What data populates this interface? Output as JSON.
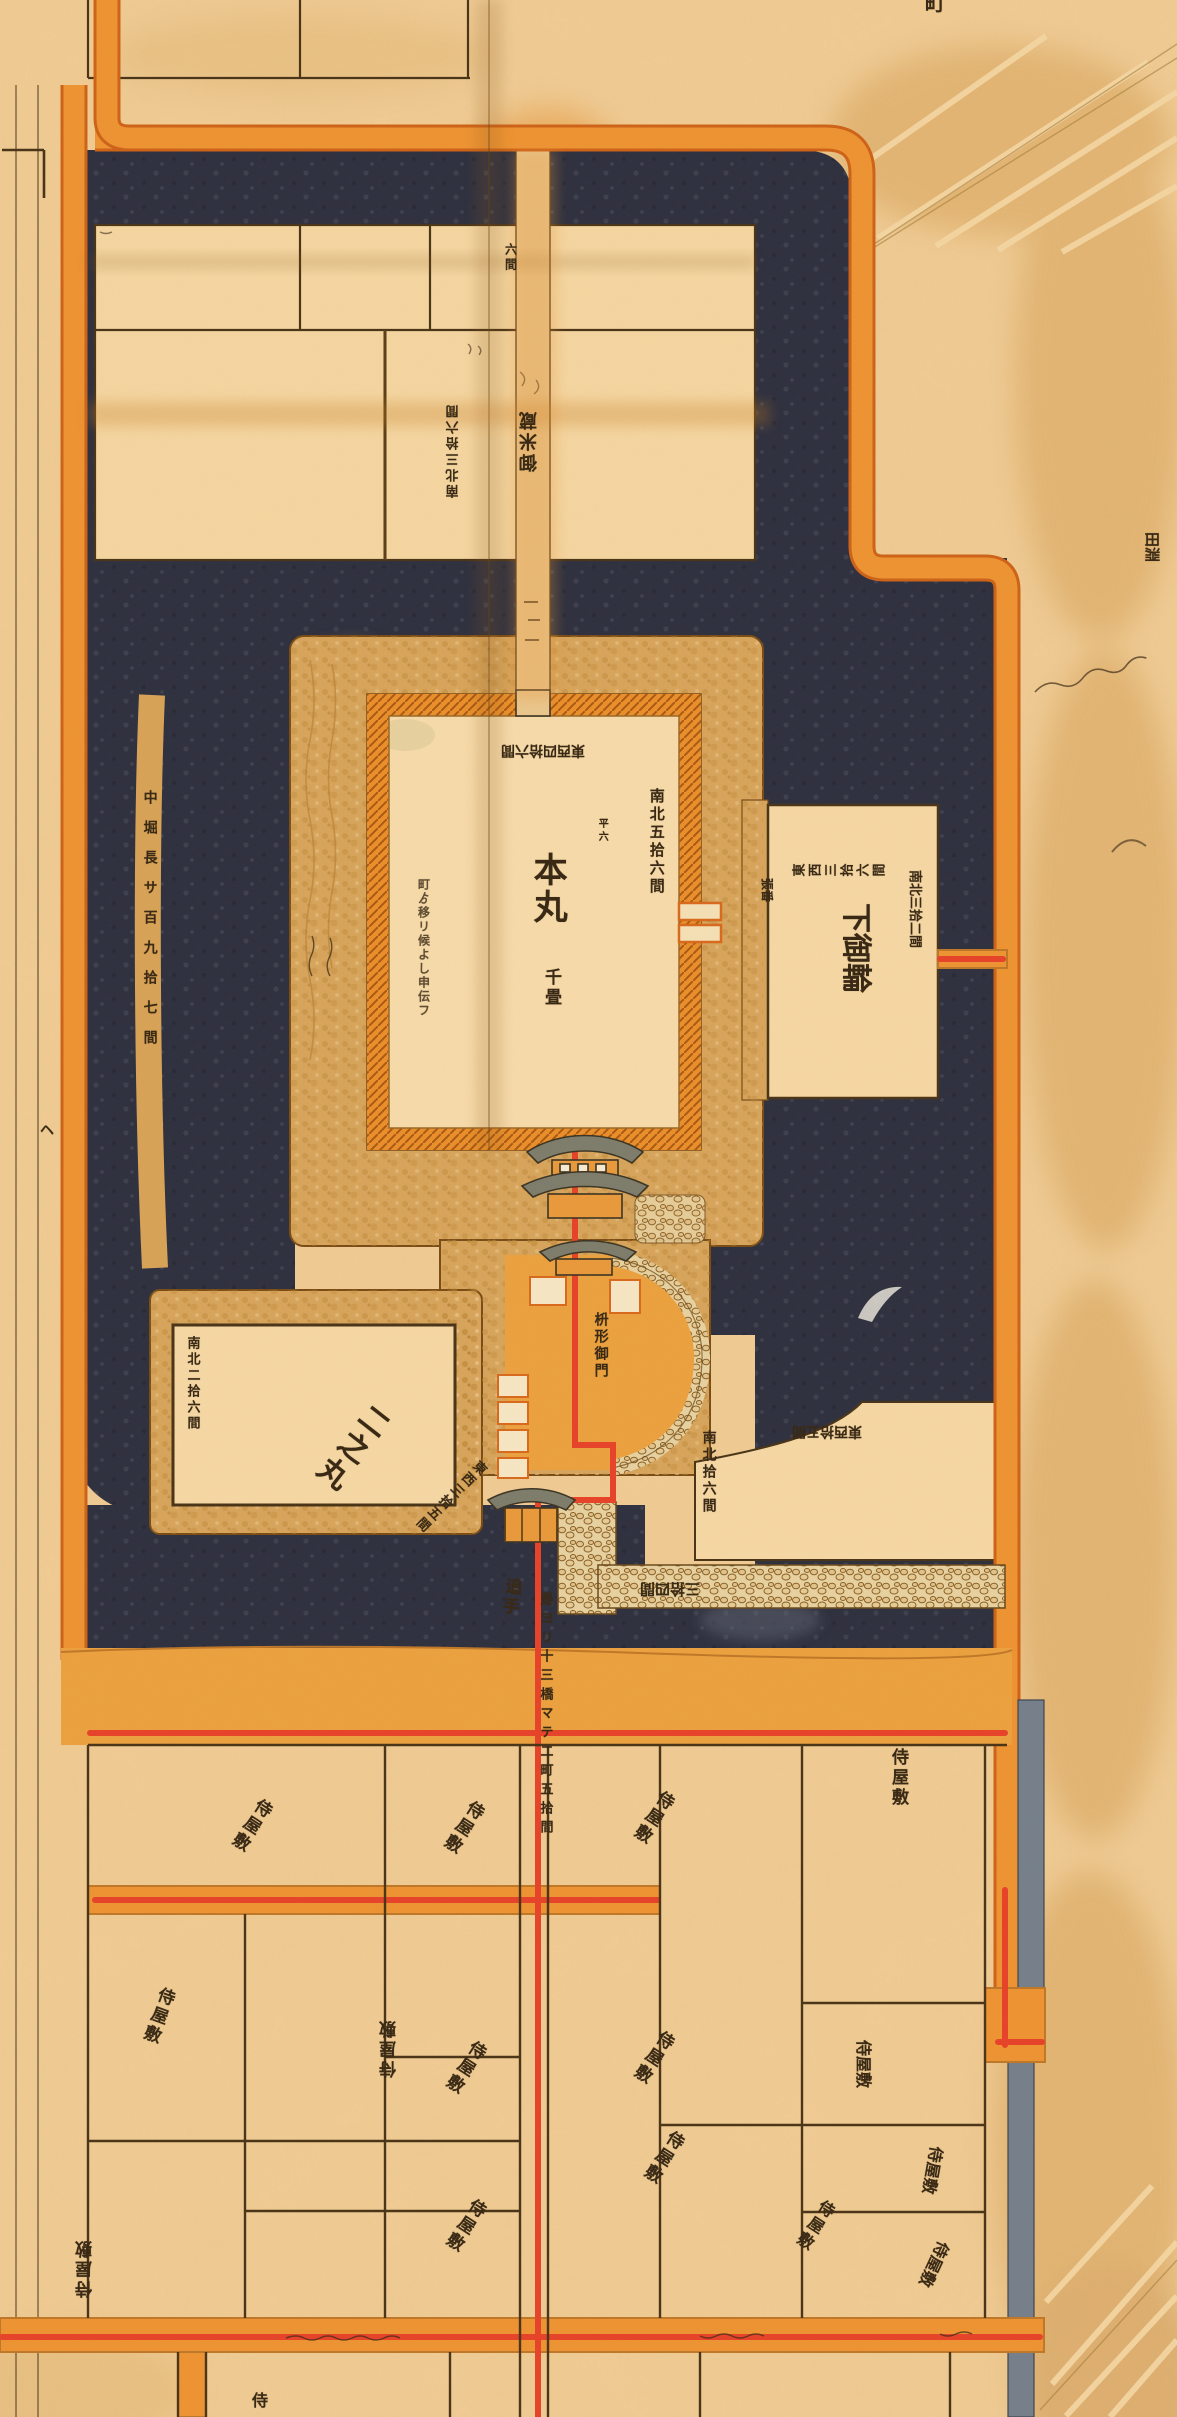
{
  "map_title": "castle-plan-map",
  "colors": {
    "paper": "#f2cd96",
    "paper_light": "#f8dcab",
    "moat_dark": "#2e3040",
    "stone_tan": "#d8a55c",
    "road_orange": "#ef9433",
    "road_edge": "#d96a1d",
    "road_red": "#e8432a",
    "wall_orange": "#ec8f2b",
    "ink": "#3a2a15",
    "drain_gray": "#76808c",
    "roof_gray": "#7e7d6c"
  },
  "labels": [
    {
      "name": "honmaru-label",
      "text": "本丸",
      "dir": "v",
      "x": 528,
      "y": 852,
      "size": 34
    },
    {
      "name": "honmaru-sub-label",
      "text": "千畳",
      "dir": "v",
      "x": 541,
      "y": 968,
      "size": 17
    },
    {
      "name": "honmaru-dim-ns",
      "text": "南北五拾六間",
      "dir": "v",
      "x": 648,
      "y": 788,
      "size": 15
    },
    {
      "name": "honmaru-dim-ew",
      "text": "東西四拾六間",
      "dir": "h",
      "x": 585,
      "y": 757,
      "size": 14,
      "rot": 180
    },
    {
      "name": "honmaru-note",
      "text": "町ゟ移リ候よし申伝フ",
      "dir": "v",
      "x": 416,
      "y": 878,
      "size": 12,
      "op": 0.8,
      "ls": 2
    },
    {
      "name": "honmaru-tiny-note",
      "text": "平六",
      "dir": "v",
      "x": 596,
      "y": 818,
      "size": 10
    },
    {
      "name": "bailey-plot-label",
      "text": "御米蔵",
      "dir": "v",
      "x": 540,
      "y": 472,
      "size": 18,
      "rot": 180
    },
    {
      "name": "bailey-dim-ns",
      "text": "南北三拾六間",
      "dir": "v",
      "x": 462,
      "y": 498,
      "size": 13,
      "rot": 180
    },
    {
      "name": "axis-road-note",
      "text": "六間",
      "dir": "v",
      "x": 503,
      "y": 243,
      "size": 12
    },
    {
      "name": "shimokuruwa-label",
      "text": "下御輪",
      "dir": "h",
      "x": 872,
      "y": 903,
      "size": 30,
      "rot": 90
    },
    {
      "name": "shimokuruwa-dim-ew",
      "text": "東西三拾六間",
      "dir": "v",
      "x": 792,
      "y": 880,
      "size": 13,
      "rot": -90
    },
    {
      "name": "shimokuruwa-dim-ns",
      "text": "南北三拾二間",
      "dir": "h",
      "x": 921,
      "y": 870,
      "size": 13,
      "rot": 90
    },
    {
      "name": "shimokuruwa-tiny",
      "text": "張番",
      "dir": "h",
      "x": 773,
      "y": 878,
      "size": 12,
      "rot": 90
    },
    {
      "name": "ninomaru-label",
      "text": "二之丸",
      "dir": "v",
      "x": 368,
      "y": 1396,
      "size": 30,
      "rot": 38
    },
    {
      "name": "ninomaru-dim-ns",
      "text": "南北二拾六間",
      "dir": "v",
      "x": 184,
      "y": 1336,
      "size": 13
    },
    {
      "name": "ninomaru-dim-ew",
      "text": "東西三拾五間",
      "dir": "v",
      "x": 478,
      "y": 1456,
      "size": 13,
      "rot": 45
    },
    {
      "name": "barbican-label",
      "text": "枡形御門",
      "dir": "v",
      "x": 592,
      "y": 1312,
      "size": 14
    },
    {
      "name": "seplot-dim-ns",
      "text": "南北拾六間",
      "dir": "v",
      "x": 700,
      "y": 1430,
      "size": 14
    },
    {
      "name": "seplot-dim-ew",
      "text": "東西拾五間",
      "dir": "h",
      "x": 862,
      "y": 1438,
      "size": 14,
      "rot": 180
    },
    {
      "name": "stonewall-dim",
      "text": "三拾四間",
      "dir": "h",
      "x": 700,
      "y": 1597,
      "size": 15,
      "rot": 180
    },
    {
      "name": "otemon-label",
      "text": "追手",
      "dir": "v",
      "x": 503,
      "y": 1576,
      "size": 17,
      "rot": 8
    },
    {
      "name": "michinori-note",
      "text": "是ヨリ十三橋マテ二町五拾間",
      "dir": "v",
      "x": 537,
      "y": 1592,
      "size": 13,
      "ls": 6
    },
    {
      "name": "nakabori-note",
      "text": "中堀長サ百九拾七間",
      "dir": "v",
      "x": 141,
      "y": 790,
      "size": 14,
      "ls": 16
    },
    {
      "name": "he-mark",
      "text": "ヘ",
      "dir": "h",
      "x": 40,
      "y": 1124,
      "size": 14
    },
    {
      "name": "machi-char",
      "text": "町",
      "dir": "h",
      "x": 925,
      "y": -8,
      "size": 20
    },
    {
      "name": "tabuchi-label",
      "text": "田淵",
      "dir": "h",
      "x": 1160,
      "y": 532,
      "size": 15,
      "rot": 90
    },
    {
      "name": "yashiki-a",
      "text": "侍屋敷",
      "dir": "v",
      "x": 888,
      "y": 1748,
      "size": 17
    },
    {
      "name": "yashiki-b",
      "text": "侍屋敷",
      "dir": "v",
      "x": 660,
      "y": 1786,
      "size": 17,
      "rot": 33
    },
    {
      "name": "yashiki-c",
      "text": "侍屋敷",
      "dir": "v",
      "x": 470,
      "y": 1796,
      "size": 17,
      "rot": 33
    },
    {
      "name": "yashiki-d",
      "text": "侍屋敷",
      "dir": "v",
      "x": 258,
      "y": 1794,
      "size": 17,
      "rot": 33
    },
    {
      "name": "yashiki-e",
      "text": "侍屋敷",
      "dir": "v",
      "x": 158,
      "y": 1984,
      "size": 17,
      "rot": 20
    },
    {
      "name": "yashiki-f",
      "text": "侍屋敷",
      "dir": "v",
      "x": 400,
      "y": 2078,
      "size": 17,
      "rot": 180
    },
    {
      "name": "yashiki-g",
      "text": "侍屋敷",
      "dir": "v",
      "x": 472,
      "y": 2036,
      "size": 17,
      "rot": 33
    },
    {
      "name": "yashiki-h",
      "text": "侍屋敷",
      "dir": "v",
      "x": 660,
      "y": 2026,
      "size": 17,
      "rot": 33
    },
    {
      "name": "yashiki-i",
      "text": "侍屋敷",
      "dir": "v",
      "x": 670,
      "y": 2126,
      "size": 17,
      "rot": 33
    },
    {
      "name": "yashiki-j",
      "text": "侍屋敷",
      "dir": "v",
      "x": 472,
      "y": 2194,
      "size": 17,
      "rot": 33
    },
    {
      "name": "yashiki-k",
      "text": "侍屋敷",
      "dir": "v",
      "x": 96,
      "y": 2298,
      "size": 17,
      "rot": 180
    },
    {
      "name": "yashiki-l",
      "text": "侍屋敷",
      "dir": "h",
      "x": 872,
      "y": 2040,
      "size": 16,
      "rot": 90
    },
    {
      "name": "yashiki-m",
      "text": "侍屋敷",
      "dir": "h",
      "x": 945,
      "y": 2148,
      "size": 16,
      "rot": 100
    },
    {
      "name": "yashiki-n",
      "text": "侍屋敷",
      "dir": "h",
      "x": 952,
      "y": 2246,
      "size": 16,
      "rot": 115
    },
    {
      "name": "yashiki-o",
      "text": "侍屋敷",
      "dir": "v",
      "x": 822,
      "y": 2196,
      "size": 16,
      "rot": 33
    },
    {
      "name": "yashiki-partial",
      "text": "侍",
      "dir": "h",
      "x": 252,
      "y": 2392,
      "size": 16
    }
  ]
}
